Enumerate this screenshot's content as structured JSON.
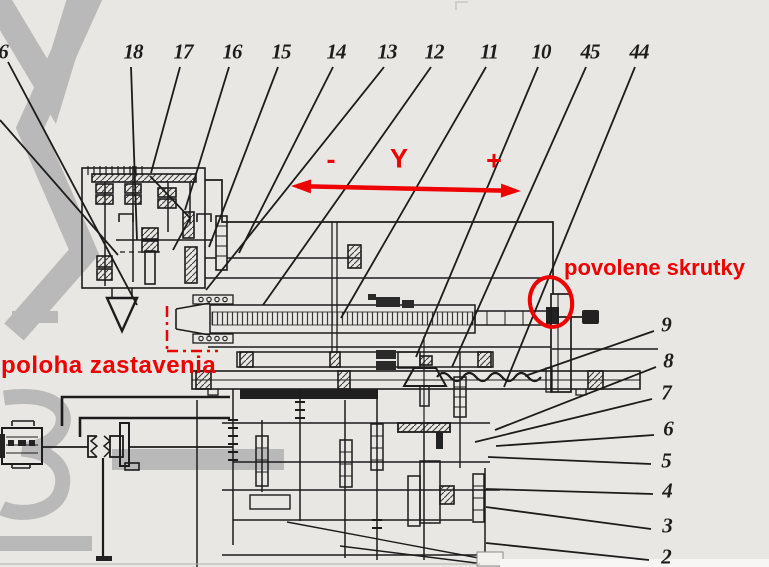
{
  "figure": {
    "type": "scanned kinematic machine diagram with red annotations",
    "background": "#e9e7e3",
    "ink_color": "#1c1c1c",
    "annotation_color": "#ee0000",
    "watermark_color": "#b9b9b9"
  },
  "axis_annotation": {
    "minus_label": "-",
    "axis_label": "Y",
    "plus_label": "+",
    "minus_pos": {
      "x": 331,
      "y": 160
    },
    "label_pos": {
      "x": 399,
      "y": 159
    },
    "plus_pos": {
      "x": 494,
      "y": 161
    },
    "arrow": {
      "x1": 291,
      "y1": 186,
      "x2": 521,
      "y2": 191
    }
  },
  "text_annotations": {
    "loosened_screws": {
      "text": "povolene skrutky",
      "x": 564,
      "y": 255
    },
    "stop_position": {
      "text": "poloha zastavenia",
      "x": 1,
      "y": 352
    }
  },
  "red_marks": {
    "screw_circle": {
      "cx": 551,
      "cy": 302,
      "rx": 21,
      "ry": 25,
      "rotate": -12
    },
    "stop_position_dash_dot_lines": [
      {
        "x1": 167,
        "y1": 306,
        "x2": 167,
        "y2": 352
      },
      {
        "x1": 167,
        "y1": 351,
        "x2": 218,
        "y2": 351
      }
    ]
  },
  "part_callouts": {
    "top": [
      {
        "label": "6",
        "lx": 3,
        "ly": 52,
        "x1": 8,
        "y1": 62,
        "x2": 137,
        "y2": 305
      },
      {
        "label": "18",
        "lx": 133,
        "ly": 52,
        "x1": 131,
        "y1": 67,
        "x2": 137,
        "y2": 240
      },
      {
        "label": "17",
        "lx": 183,
        "ly": 52,
        "x1": 180,
        "y1": 67,
        "x2": 151,
        "y2": 173
      },
      {
        "label": "16",
        "lx": 232,
        "ly": 52,
        "x1": 229,
        "y1": 67,
        "x2": 185,
        "y2": 210
      },
      {
        "label": "15",
        "lx": 281,
        "ly": 52,
        "x1": 278,
        "y1": 67,
        "x2": 209,
        "y2": 247
      },
      {
        "label": "14",
        "lx": 336,
        "ly": 52,
        "x1": 333,
        "y1": 67,
        "x2": 239,
        "y2": 253
      },
      {
        "label": "13",
        "lx": 387,
        "ly": 52,
        "x1": 384,
        "y1": 67,
        "x2": 206,
        "y2": 290
      },
      {
        "label": "12",
        "lx": 434,
        "ly": 52,
        "x1": 431,
        "y1": 67,
        "x2": 263,
        "y2": 305
      },
      {
        "label": "11",
        "lx": 489,
        "ly": 52,
        "x1": 486,
        "y1": 67,
        "x2": 341,
        "y2": 318
      },
      {
        "label": "10",
        "lx": 541,
        "ly": 52,
        "x1": 538,
        "y1": 67,
        "x2": 416,
        "y2": 357
      },
      {
        "label": "45",
        "lx": 590,
        "ly": 52,
        "x1": 586,
        "y1": 67,
        "x2": 452,
        "y2": 367
      },
      {
        "label": "44",
        "lx": 639,
        "ly": 52,
        "x1": 635,
        "y1": 67,
        "x2": 504,
        "y2": 387
      }
    ],
    "right": [
      {
        "label": "9",
        "lx": 666,
        "ly": 325,
        "x1": 654,
        "y1": 331,
        "x2": 525,
        "y2": 376
      },
      {
        "label": "8",
        "lx": 668,
        "ly": 361,
        "x1": 656,
        "y1": 367,
        "x2": 495,
        "y2": 430
      },
      {
        "label": "7",
        "lx": 666,
        "ly": 393,
        "x1": 652,
        "y1": 399,
        "x2": 475,
        "y2": 442
      },
      {
        "label": "6",
        "lx": 668,
        "ly": 429,
        "x1": 654,
        "y1": 435,
        "x2": 496,
        "y2": 446
      },
      {
        "label": "5",
        "lx": 666,
        "ly": 461,
        "x1": 651,
        "y1": 464,
        "x2": 488,
        "y2": 457
      },
      {
        "label": "4",
        "lx": 667,
        "ly": 491,
        "x1": 653,
        "y1": 494,
        "x2": 486,
        "y2": 489
      },
      {
        "label": "3",
        "lx": 667,
        "ly": 526,
        "x1": 651,
        "y1": 529,
        "x2": 486,
        "y2": 507
      },
      {
        "label": "2",
        "lx": 666,
        "ly": 557,
        "x1": 649,
        "y1": 560,
        "x2": 486,
        "y2": 543
      }
    ],
    "extra_leader_lines": [
      {
        "x1": 0,
        "y1": 120,
        "x2": 118,
        "y2": 255
      }
    ]
  }
}
